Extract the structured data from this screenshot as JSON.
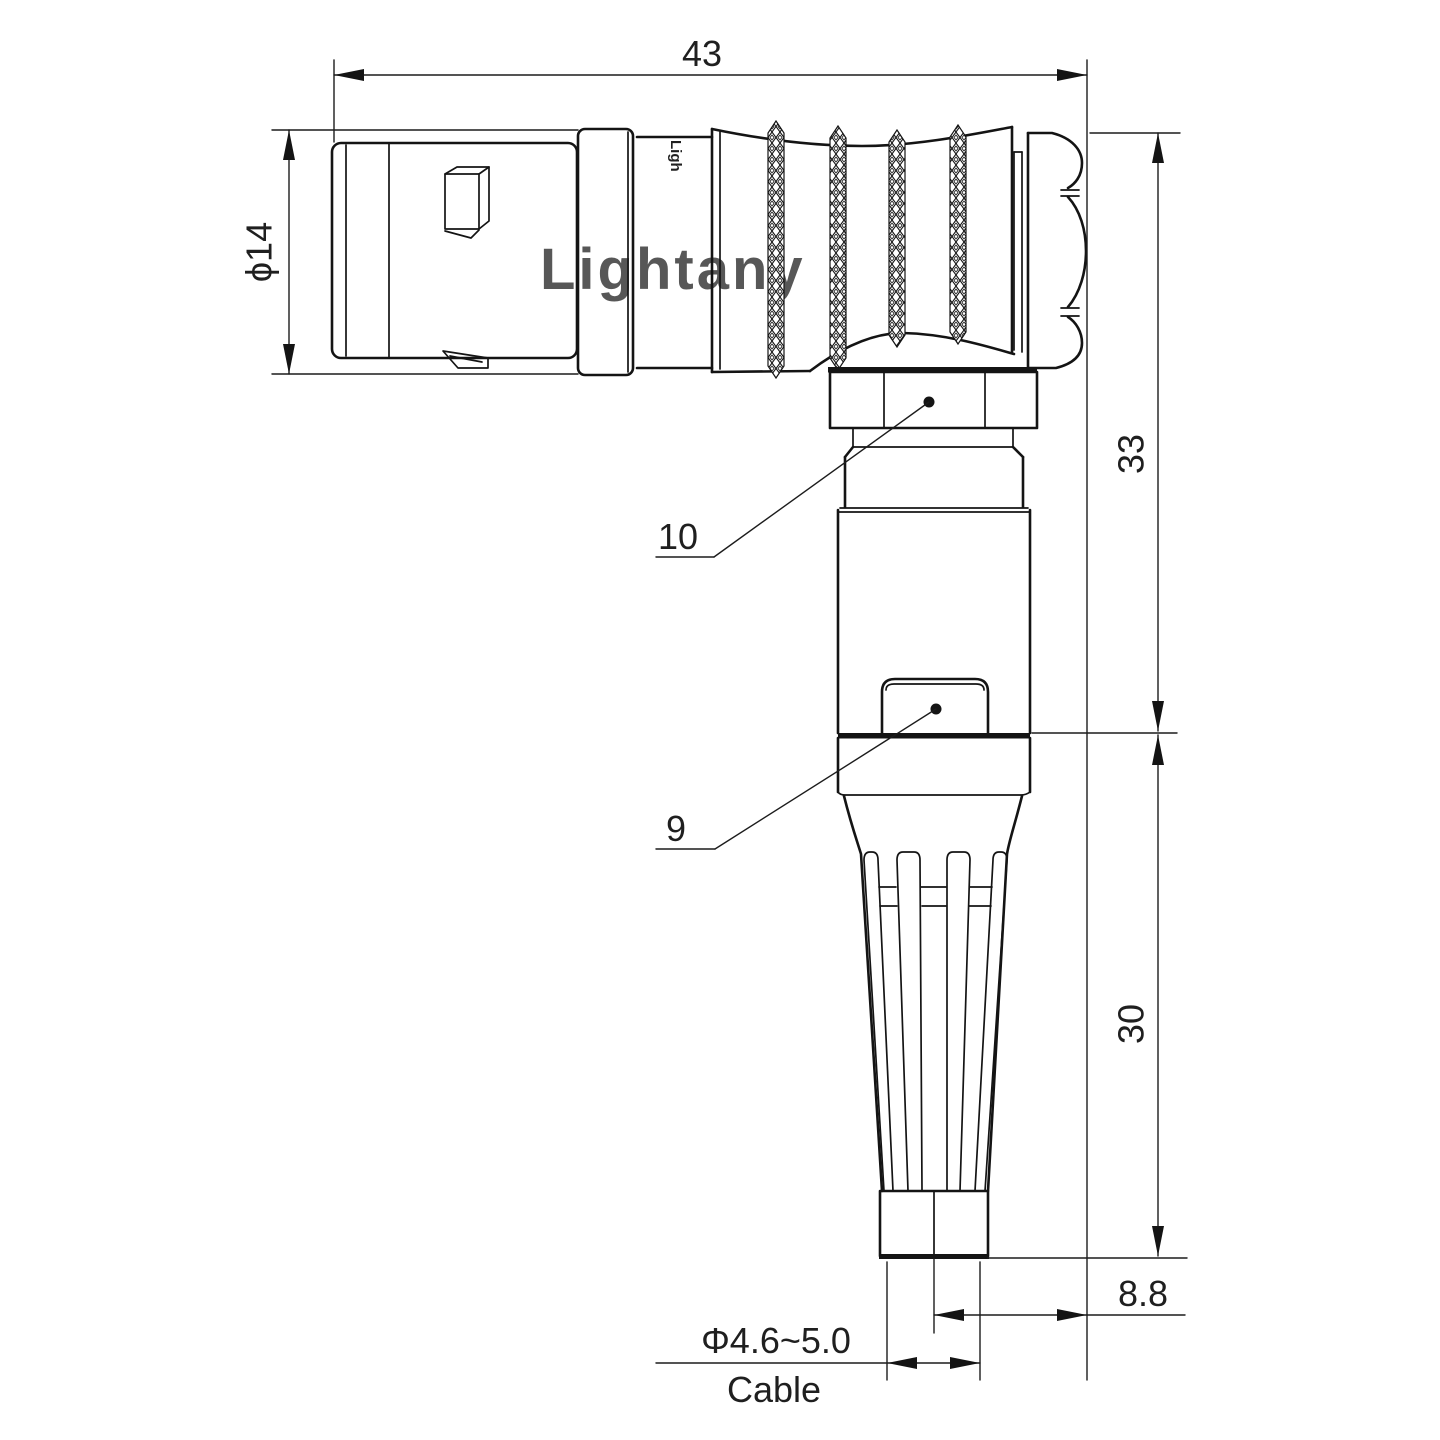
{
  "drawing": {
    "watermark_text": "Lightany",
    "brand_mark_text": "Ligh",
    "dimensions": {
      "overall_length": "43",
      "flange_diameter": "ϕ14",
      "upper_height": "33",
      "lower_height": "30",
      "cable_offset": "8.8",
      "cable_diameter_range": "Φ4.6~5.0",
      "cable_word": "Cable"
    },
    "callouts": {
      "coupling_nut": "10",
      "release_latch": "9"
    },
    "colors": {
      "line": "#141414",
      "watermark": "#f3bdbd",
      "background": "#ffffff"
    }
  }
}
